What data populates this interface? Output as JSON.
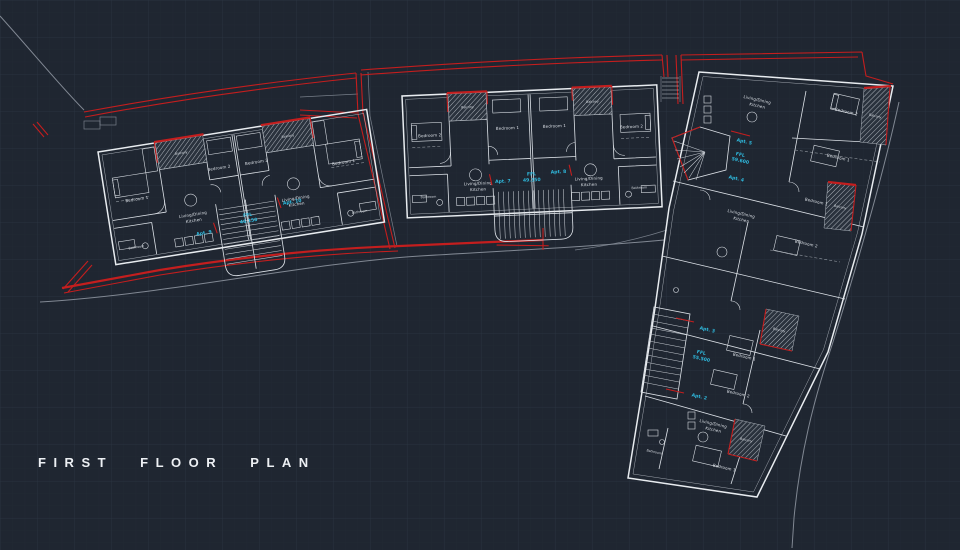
{
  "title": "FIRST FLOOR PLAN",
  "colors": {
    "background": "#1f2631",
    "grid_minor": "#232b36",
    "grid_major": "#2c3642",
    "walls": "#e8ecf0",
    "boundary_red": "#c41e1e",
    "label_cyan": "#2fb9dd",
    "site_grey": "#818893"
  },
  "strings": {
    "bedroom1": "Bedroom 1",
    "bedroom2": "Bedroom 2",
    "living_line1": "Living/Dining",
    "living_line2": "Kitchen",
    "bathroom": "Bathroom",
    "balcony": "Balcony"
  },
  "apartments": {
    "building_a": {
      "left": "Apt. 9",
      "ffl_line1": "FFL",
      "ffl_line2": "46.150",
      "right": "Apt. 10"
    },
    "building_b": {
      "left": "Apt. 7",
      "ffl_line1": "FFL",
      "ffl_line2": "49.350",
      "right": "Apt. 8"
    },
    "building_c_upper": {
      "upper": "Apt. 5",
      "ffl_line1": "FFL",
      "ffl_line2": "59.600",
      "lower": "Apt. 4"
    },
    "building_c_lower": {
      "upper": "Apt. 3",
      "ffl_line1": "FFL",
      "ffl_line2": "55.500",
      "lower": "Apt. 2"
    }
  }
}
